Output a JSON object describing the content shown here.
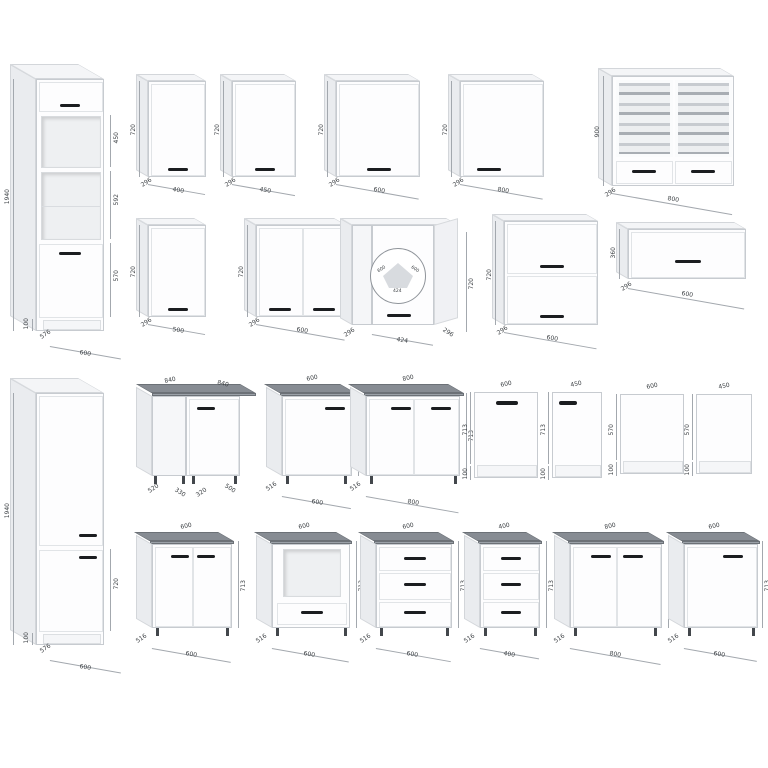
{
  "sheet": {
    "description": "Kitchen cabinet modules dimension drawing"
  },
  "colors": {
    "cabinet": "#fdfdfe",
    "side_face": "#eaecef",
    "countertop": "#878c93",
    "handle": "#1b1d20",
    "dim_line": "#a3a8ae",
    "glass": "#c7cbd0"
  },
  "dims": {
    "t1": {
      "h": "1940",
      "a": "450",
      "b": "592",
      "c": "570",
      "p": "100",
      "d": "576",
      "w": "600"
    },
    "r1c1": {
      "w": "400",
      "h": "720",
      "d": "296"
    },
    "r1c2": {
      "w": "450",
      "h": "720",
      "d": "296"
    },
    "r1c3": {
      "w": "600",
      "h": "720",
      "d": "296"
    },
    "r1c4": {
      "w": "800",
      "h": "720",
      "d": "296"
    },
    "r1c5": {
      "w": "800",
      "h": "900",
      "d": "296"
    },
    "r2c1": {
      "w": "500",
      "h": "720",
      "d": "296"
    },
    "r2c2": {
      "w": "600",
      "h": "720",
      "d": "296"
    },
    "r2c3": {
      "h": "720",
      "w": "424",
      "dl": "296",
      "dr": "296",
      "p1": "600",
      "p2": "600",
      "p3": "424"
    },
    "r2c4": {
      "w": "600",
      "h": "720",
      "d": "296"
    },
    "r2c5": {
      "w": "600",
      "h": "360",
      "d": "296"
    },
    "t2": {
      "h": "1940",
      "b": "720",
      "p": "100",
      "d": "576",
      "w": "600"
    },
    "b1c1": {
      "tl": "840",
      "tr": "840",
      "b1": "520",
      "b2": "330",
      "b3": "320",
      "b4": "500"
    },
    "b1c2": {
      "w": "600",
      "h": "713",
      "d": "516",
      "b": "600"
    },
    "b1c3": {
      "w": "800",
      "h": "713",
      "d": "516",
      "b": "800"
    },
    "b1c4": {
      "w": "600",
      "h": "713",
      "p": "100"
    },
    "b1c5": {
      "w": "450",
      "h": "713",
      "p": "100"
    },
    "b1c6": {
      "w": "600",
      "h": "570",
      "p": "100"
    },
    "b1c7": {
      "w": "450",
      "h": "570",
      "p": "100"
    },
    "b2c1": {
      "w": "600",
      "h": "713",
      "d": "516",
      "b": "600"
    },
    "b2c2": {
      "w": "600",
      "h": "713",
      "d": "516",
      "b": "600"
    },
    "b2c3": {
      "w": "600",
      "h": "713",
      "d": "516",
      "b": "600"
    },
    "b2c4": {
      "w": "400",
      "h": "713",
      "d": "516",
      "b": "400"
    },
    "b2c5": {
      "w": "800",
      "h": "713",
      "d": "516",
      "b": "800"
    },
    "b2c6": {
      "w": "600",
      "h": "713",
      "d": "516",
      "b": "600"
    }
  }
}
